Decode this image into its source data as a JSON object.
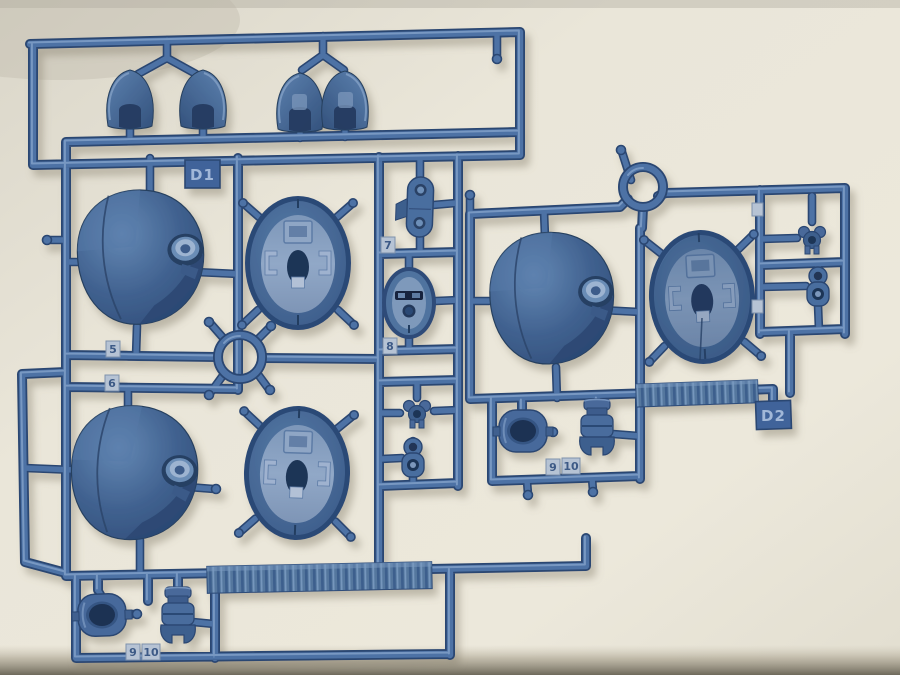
{
  "scene": {
    "background_hex": "#e9e5d8",
    "plastic_hex": "#4d72a5",
    "plastic_dark_hex": "#2b4672",
    "plastic_light_hex": "#8aa8ce",
    "sprues": [
      {
        "name": "left",
        "gate_label": "D1",
        "part_tags": [
          "5",
          "6",
          "7",
          "8",
          "9",
          "10"
        ]
      },
      {
        "name": "right",
        "gate_label": "D2",
        "part_tags": [
          "9",
          "10"
        ]
      }
    ]
  }
}
